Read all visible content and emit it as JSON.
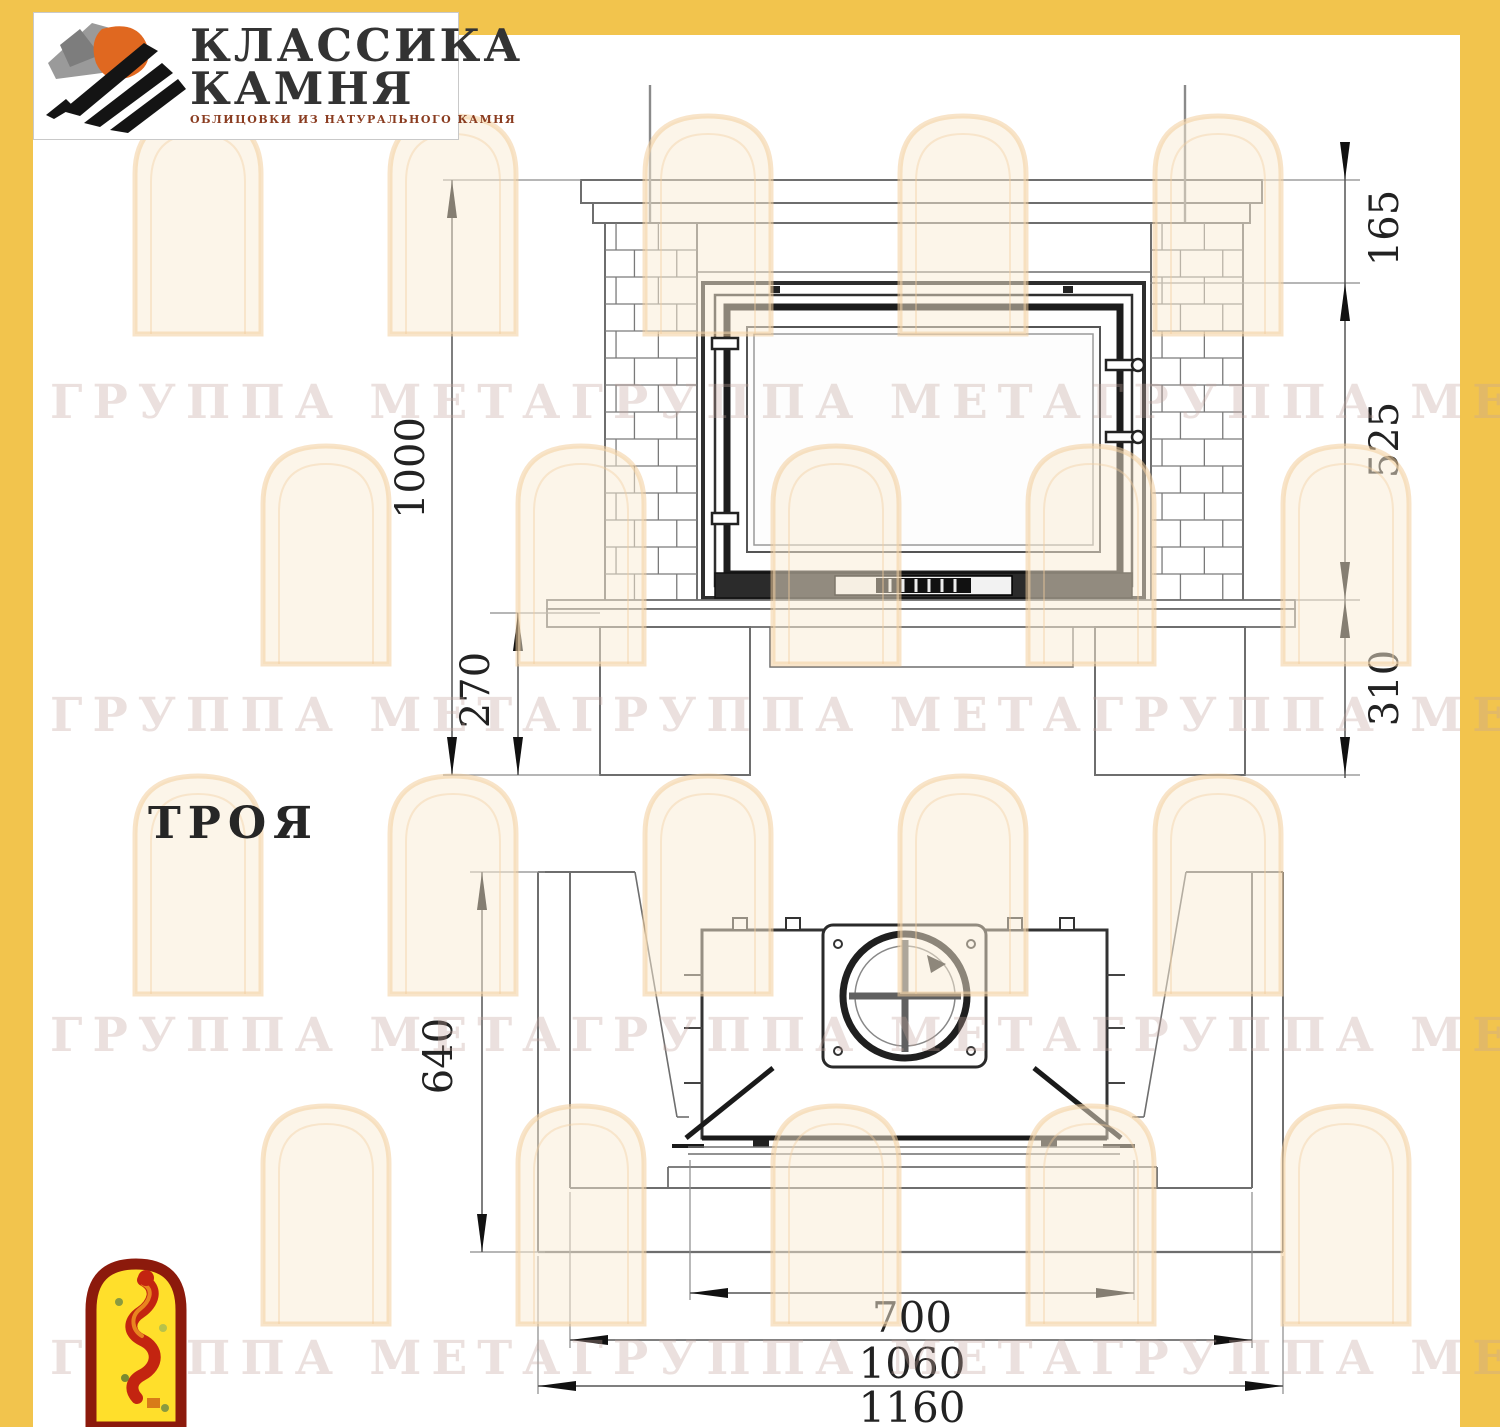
{
  "page": {
    "border_color": "#f2c44d",
    "paper_color": "#ffffff",
    "line_color": "#6e6e6e",
    "dark_line_color": "#1c1c1c"
  },
  "logo": {
    "line1": "КЛАССИКА",
    "line2": "КАМНЯ",
    "subtitle": "ОБЛИЦОВКИ ИЗ НАТУРАЛЬНОГО КАМНЯ",
    "emblem_icon": "stone-classic-emblem",
    "emblem_colors": {
      "gray": "#9a9a9a",
      "orange": "#e06820",
      "black": "#141414"
    }
  },
  "model": {
    "name": "ТРОЯ"
  },
  "watermark": {
    "text": "ГРУППА МЕТАГРУППА МЕТАГРУППА МЕТА",
    "arch_stroke": "#f3cd9d",
    "arch_fill": "#faecd4"
  },
  "front_view": {
    "dims": {
      "total_height": "1000",
      "mantel_height": "165",
      "opening_height": "525",
      "base_height": "310",
      "pedestal_height": "270"
    }
  },
  "plan_view": {
    "dims": {
      "depth": "640",
      "firebox_width": "700",
      "inner_width": "1060",
      "total_width": "1160"
    }
  },
  "badge": {
    "icon": "meta-flame-badge",
    "colors": {
      "fill": "#ffdf2b",
      "border": "#8c1a0c",
      "flame": "#c32410"
    }
  }
}
